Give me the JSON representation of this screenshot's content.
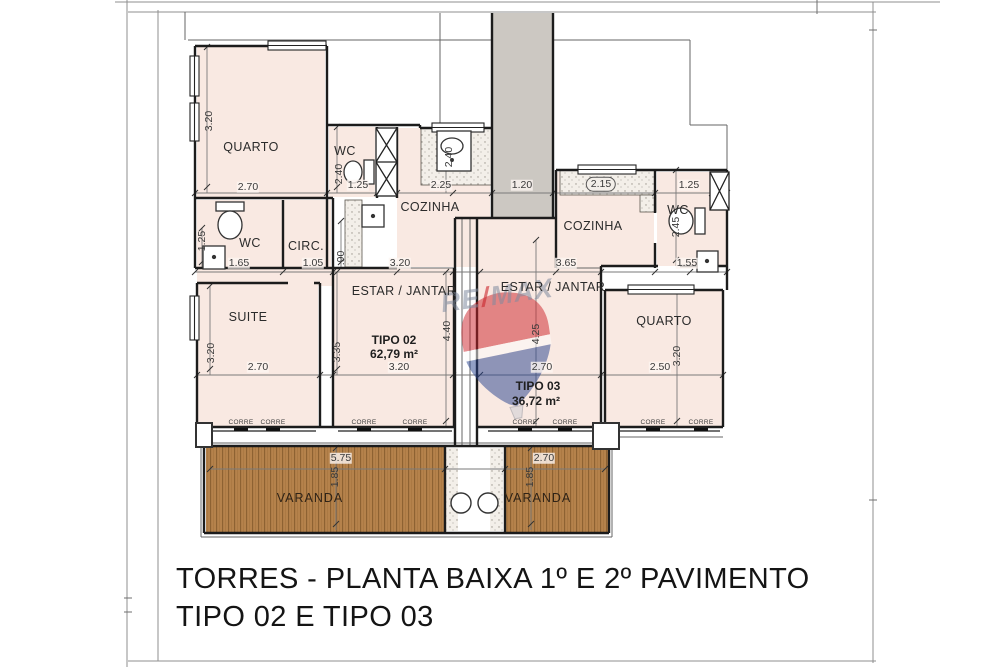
{
  "sheet": {
    "title_line1": "TORRES - PLANTA BAIXA 1º E 2º PAVIMENTO",
    "title_line2": "TIPO 02 E TIPO 03"
  },
  "watermark": {
    "re": "RE",
    "slash": "/",
    "max": "MAX"
  },
  "plan": {
    "corridor": {
      "width": "1.20"
    },
    "door_label": "CORRE",
    "unit2": {
      "quarto": {
        "name": "QUARTO",
        "width": "2.70",
        "height": "3.20"
      },
      "wc": {
        "name": "WC",
        "width": "1.25",
        "height": "2.40"
      },
      "cozinha": {
        "name": "COZINHA",
        "width": "2.25",
        "counter_height": "2.40"
      },
      "wc_suite": {
        "name": "WC",
        "width": "1.65",
        "nook_height": "1.25"
      },
      "circ": {
        "name": "CIRC.",
        "width": "1.05",
        "height": ".90"
      },
      "suite": {
        "name": "SUITE",
        "width": "2.70",
        "height": "3.20"
      },
      "estar": {
        "name": "ESTAR / JANTAR",
        "top_width": "3.20",
        "bottom_width": "3.20",
        "height": "4.40",
        "left_height": "3.35"
      },
      "tipo": {
        "label": "TIPO 02",
        "area": "62,79 m²"
      },
      "varanda": {
        "name": "VARANDA",
        "width": "5.75",
        "height": "1.85"
      }
    },
    "unit3": {
      "cozinha": {
        "name": "COZINHA",
        "counter_width": "2.15",
        "bottom_width": "3.65"
      },
      "wc": {
        "name": "WC",
        "top_width": "1.25",
        "width": "1.55",
        "height": "2.45"
      },
      "estar": {
        "name": "ESTAR / JANTAR",
        "bottom_width": "2.70",
        "height": "4.25"
      },
      "tipo": {
        "label": "TIPO 03",
        "area": "36,72 m²"
      },
      "quarto": {
        "name": "QUARTO",
        "width": "2.50",
        "height": "3.20"
      },
      "varanda": {
        "name": "VARANDA",
        "width": "2.70",
        "height": "1.85"
      }
    }
  }
}
